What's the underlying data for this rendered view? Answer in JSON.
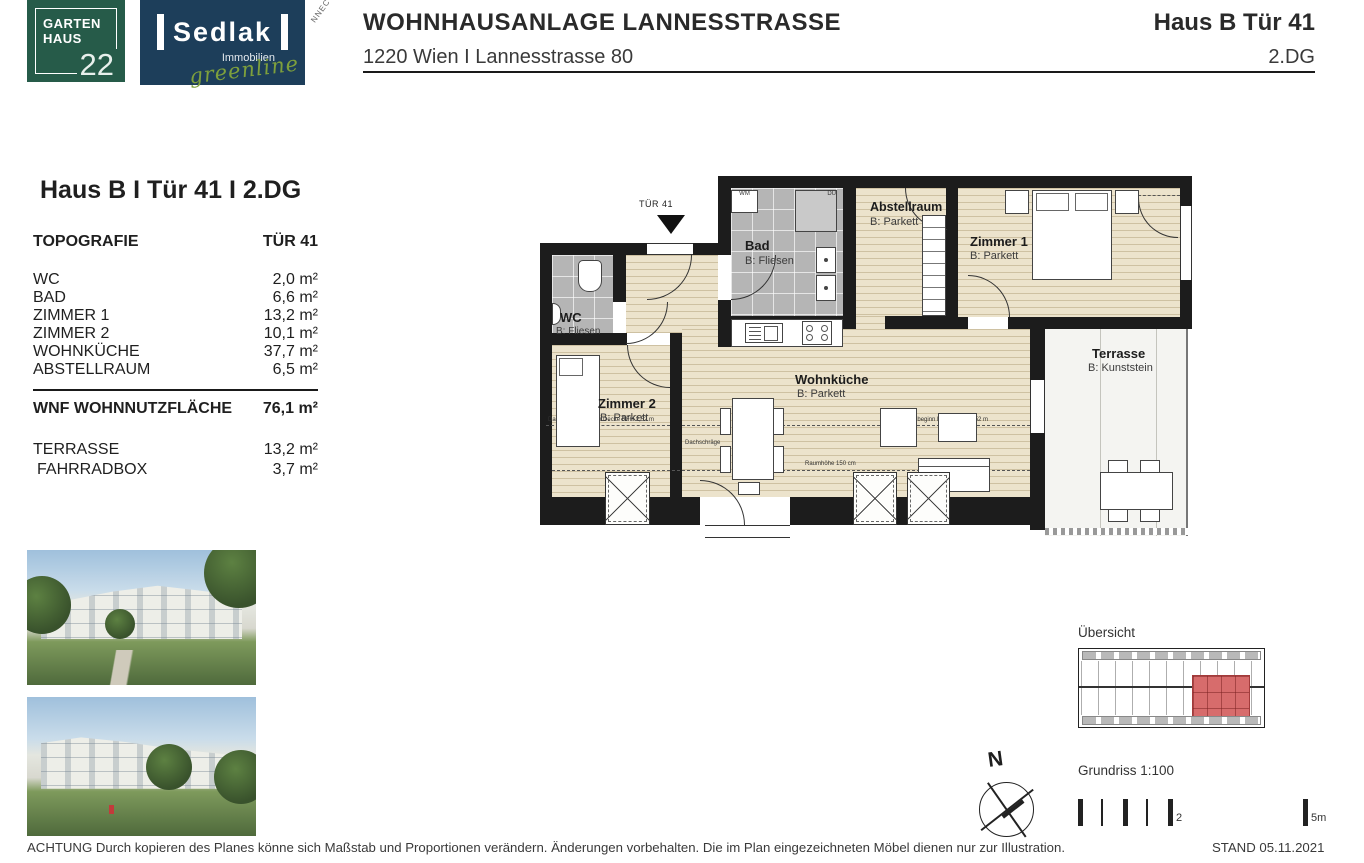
{
  "page": {
    "title": "WOHNHAUSANLAGE LANNESSTRASSE",
    "subtitle": "1220 Wien I Lannesstrasse 80",
    "unit": "Haus B Tür 41",
    "floor": "2.DG"
  },
  "logos": {
    "garten": {
      "line1": "GARTEN",
      "line2": "HAUS",
      "number": "22",
      "color": "#265b49"
    },
    "sedlak": {
      "name": "Sedlak",
      "sub": "Immobilien",
      "script": "greenline",
      "color": "#1d3e5a",
      "script_color": "#7ea03c"
    },
    "stamp_fragment": "NNECT"
  },
  "info_panel": {
    "heading": "Haus B I Tür 41 I 2.DG",
    "col_left": "TOPOGRAFIE",
    "col_right": "TÜR 41",
    "rooms": [
      {
        "label": "WC",
        "area": "2,0 m²"
      },
      {
        "label": "BAD",
        "area": "6,6 m²"
      },
      {
        "label": "ZIMMER 1",
        "area": "13,2 m²"
      },
      {
        "label": "ZIMMER 2",
        "area": "10,1 m²"
      },
      {
        "label": "WOHNKÜCHE",
        "area": "37,7 m²"
      },
      {
        "label": "ABSTELLRAUM",
        "area": "6,5 m²"
      }
    ],
    "total_label": "WNF WOHNNUTZFLÄCHE",
    "total_area": "76,1 m²",
    "extras": [
      {
        "label": "TERRASSE",
        "area": "13,2 m²"
      },
      {
        "label": "FAHRRADBOX",
        "area": "3,7 m²"
      }
    ]
  },
  "floorplan": {
    "entrance_label": "TÜR 41",
    "rooms": {
      "wc": {
        "name": "WC",
        "floor": "B: Fliesen"
      },
      "bad": {
        "name": "Bad",
        "floor": "B: Fliesen"
      },
      "abstellraum": {
        "name": "Abstellraum",
        "floor": "B: Parkett"
      },
      "zimmer1": {
        "name": "Zimmer 1",
        "floor": "B: Parkett"
      },
      "zimmer2": {
        "name": "Zimmer 2",
        "floor": "B: Parkett"
      },
      "wohnkueche": {
        "name": "Wohnküche",
        "floor": "B: Parkett"
      },
      "terrasse": {
        "name": "Terrasse",
        "floor": "B: Kunststein"
      }
    },
    "appliances": {
      "wm": "WM",
      "du": "DU"
    },
    "annotations": {
      "dachschraege_links": "Dachschrägebeginn Decke RFH 2,52 m",
      "dachschraege": "Dachschräge",
      "raumhoehe": "Raumhöhe 150 cm",
      "dachschraege_rechts": "Dachschrägebeginn Decke RFH 2,52 m"
    }
  },
  "overview": {
    "title": "Übersicht",
    "highlight_color": "#d76c6c"
  },
  "meta": {
    "compass_n": "N",
    "scale_label": "Grundriss 1:100",
    "scale_mid": "2",
    "scale_end": "5m"
  },
  "footer": {
    "disclaimer": "ACHTUNG Durch kopieren des Planes könne sich Maßstab und Proportionen verändern. Änderungen vorbehalten. Die im Plan eingezeichneten Möbel dienen nur zur Illustration.",
    "stand": "STAND 05.11.2021"
  }
}
